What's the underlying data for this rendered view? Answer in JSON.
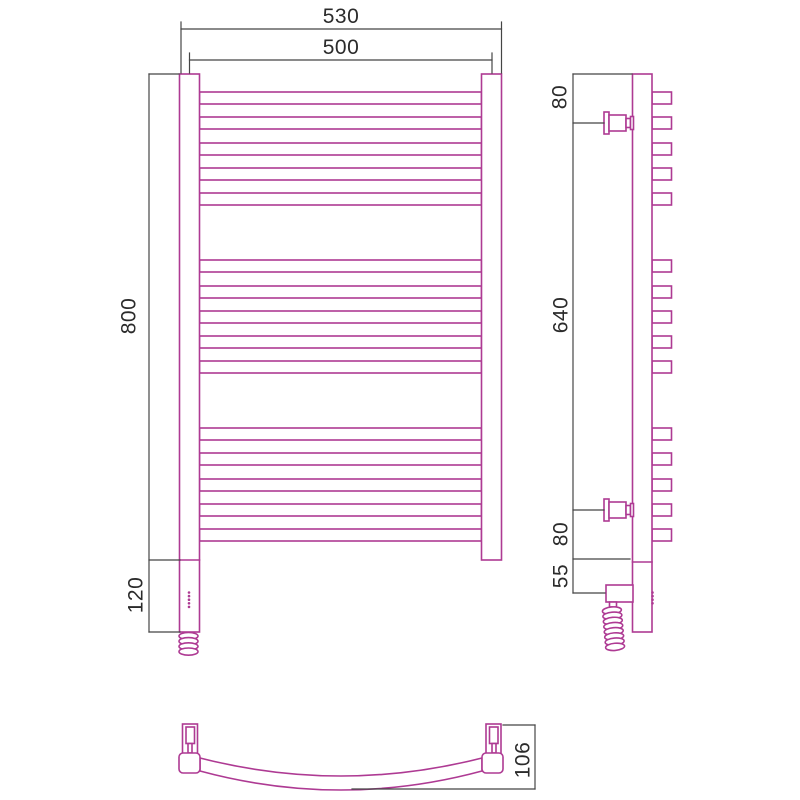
{
  "drawing": {
    "subject": "towel-rail-technical-drawing",
    "colors": {
      "part": "#ae3a93",
      "dim": "#454545",
      "text": "#2b2b2b",
      "background": "#ffffff"
    },
    "views": {
      "front": {
        "dims": {
          "overall_width": "530",
          "center_width": "500",
          "height": "800",
          "electric_height": "120"
        }
      },
      "side": {
        "dims": {
          "top_bracket_offset": "80",
          "bracket_span": "640",
          "bottom_bracket_offset": "80",
          "electric_offset": "55"
        }
      },
      "bottom": {
        "dims": {
          "depth": "106"
        }
      }
    },
    "geometry": {
      "tube_group_tops": [
        [
          92,
          117,
          143,
          168,
          193
        ],
        [
          260,
          286,
          311,
          336,
          361
        ],
        [
          428,
          453,
          479,
          504,
          529
        ]
      ],
      "tube_height": 12,
      "front_tube": {
        "x": 199.5,
        "w": 282
      },
      "side_stub": {
        "x": 652,
        "w": 19.5
      },
      "bracket_centers": [
        123,
        510
      ],
      "front_led": {
        "x": 189,
        "y_start": 592.5,
        "count": 5,
        "step": 3.6
      },
      "side_led": {
        "x": 652.5,
        "y_start": 592.5,
        "count": 4,
        "step": 3.6
      },
      "front_coil": {
        "cx": 188.5,
        "y_start": 636,
        "loops": 4,
        "pitch": 5.2,
        "rx": 9.5,
        "ry": 3.6,
        "tilt": 0
      },
      "side_coil": {
        "cx": 613.5,
        "y_start": 610.5,
        "loops": 8,
        "pitch": 5.2,
        "rx": 9.5,
        "ry": 3.6,
        "tilt": -5
      }
    }
  }
}
